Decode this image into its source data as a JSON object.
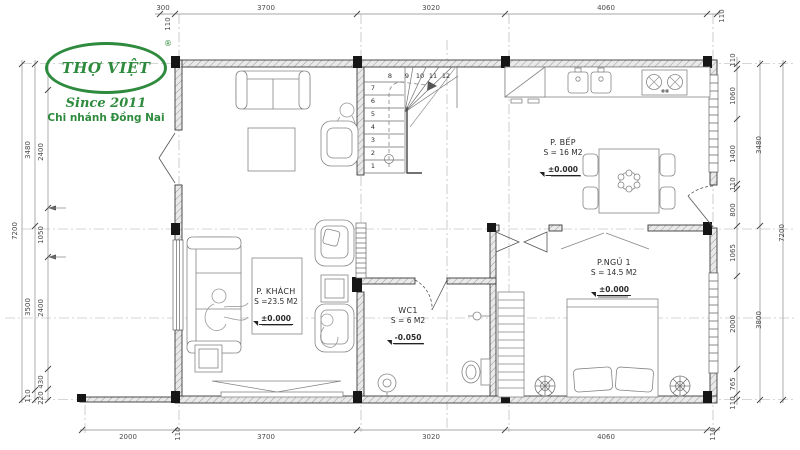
{
  "logo": {
    "brand": "THỢ VIỆT",
    "registered": "®",
    "tagline": "Since 2011",
    "branch": "Chi nhánh Đồng Nai",
    "color": "#2e8b3d"
  },
  "rooms": {
    "living": {
      "name": "P. KHÁCH",
      "area": "S =23.5 M2",
      "level": "±0.000"
    },
    "kitchen": {
      "name": "P. BẾP",
      "area": "S = 16 M2",
      "level": "±0.000"
    },
    "bedroom": {
      "name": "P.NGỦ 1",
      "area": "S = 14.5 M2",
      "level": "±0.000"
    },
    "wc": {
      "name": "WC1",
      "area": "S = 6 M2",
      "level": "-0.050"
    }
  },
  "stairs": {
    "steps": [
      "1",
      "2",
      "3",
      "4",
      "5",
      "6",
      "7",
      "8",
      "9",
      "10",
      "11",
      "12"
    ]
  },
  "dimensions": {
    "top": [
      "300",
      "3700",
      "3020",
      "4060",
      "110"
    ],
    "top_extra": "110",
    "bottom": [
      "2000",
      "110",
      "3700",
      "3020",
      "4060",
      "110"
    ],
    "left": {
      "outer": "7200",
      "mid": [
        "3480",
        "3500",
        "110"
      ],
      "inner": [
        "2400",
        "1050",
        "2400",
        "430",
        "220"
      ]
    },
    "right": {
      "outer": "7200",
      "mid": [
        "3480",
        "3800"
      ],
      "inner": [
        "110",
        "1060",
        "1400",
        "110",
        "800",
        "1065",
        "2000",
        "765",
        "110"
      ]
    }
  },
  "colors": {
    "logo_green": "#2e8b3d",
    "wall_line": "#3a3a3a",
    "dim_gray": "#4a4a4a",
    "column_black": "#161616"
  }
}
